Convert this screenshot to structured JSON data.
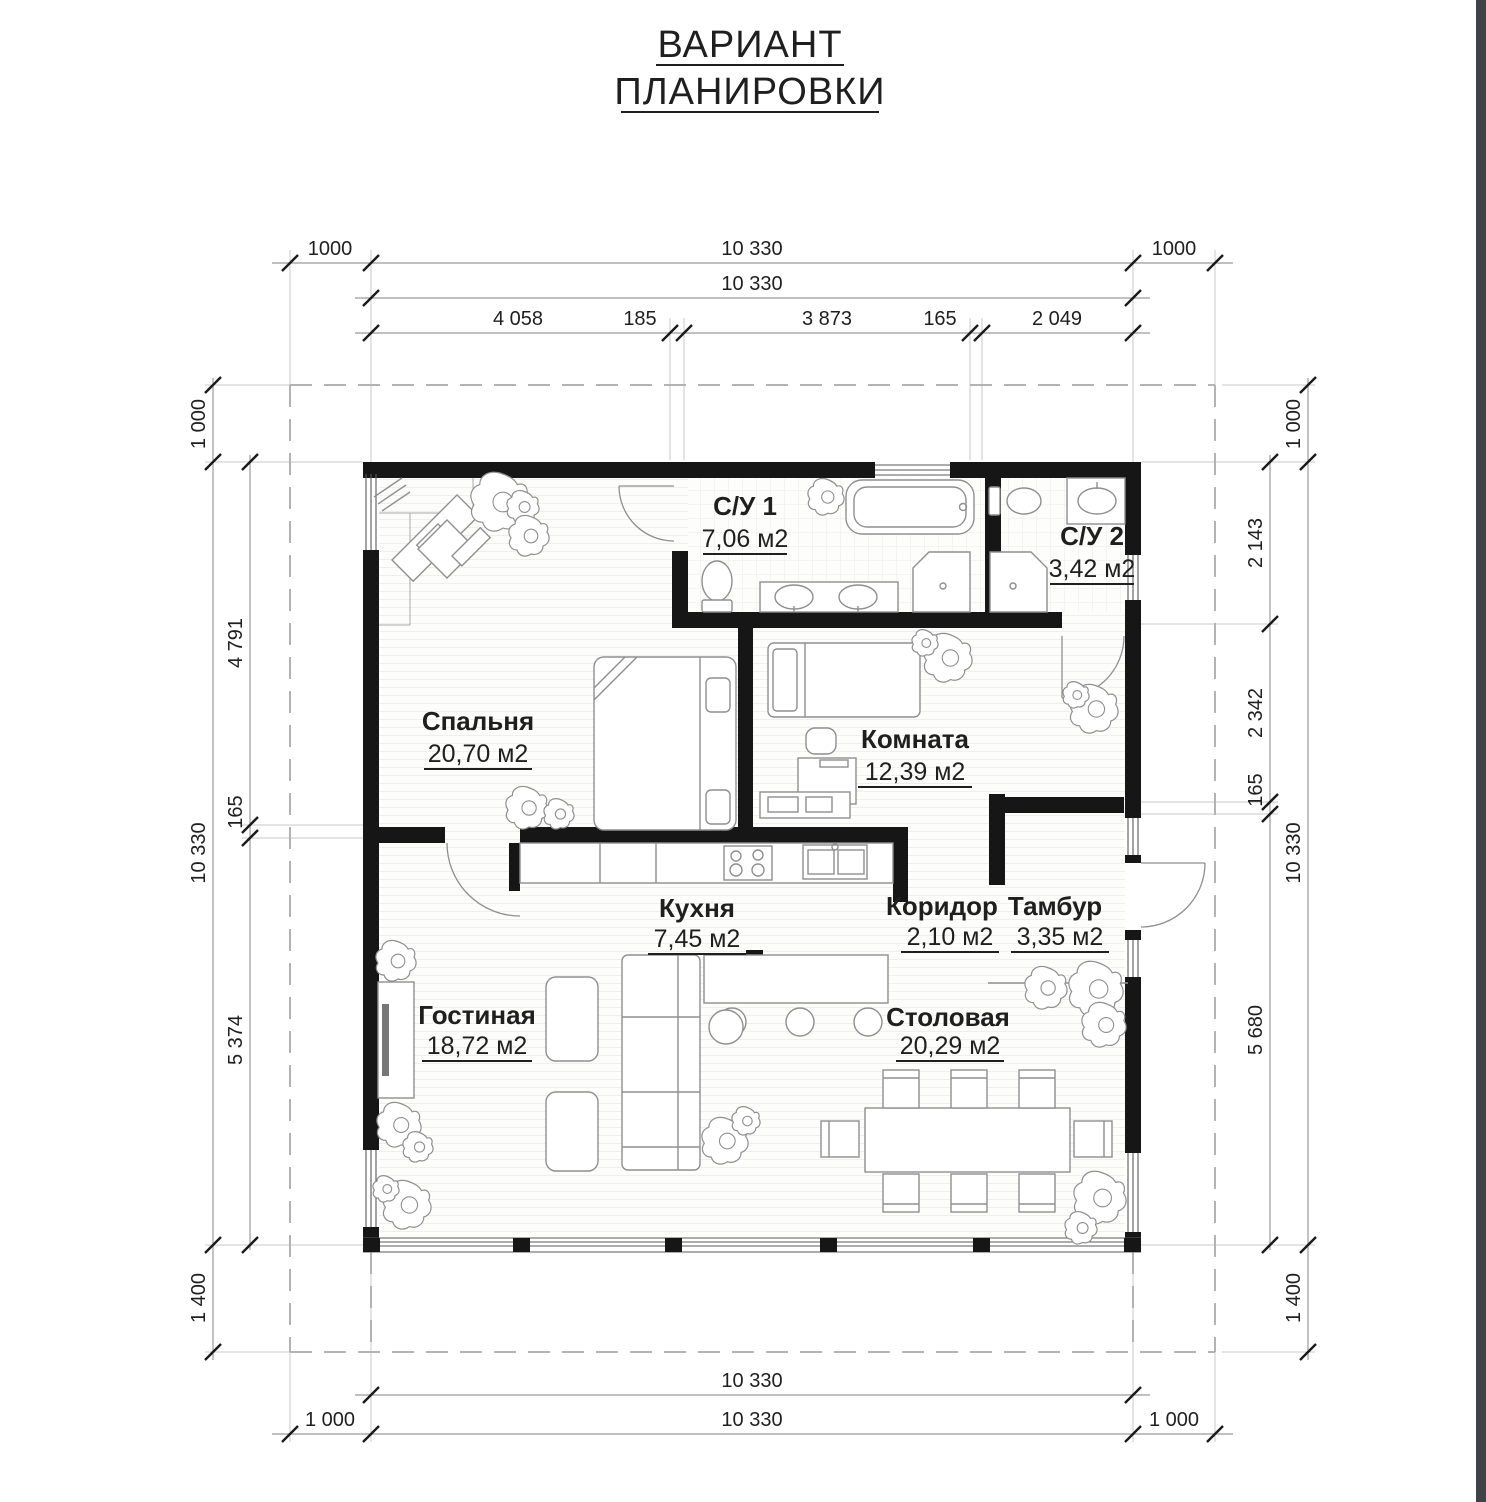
{
  "title": {
    "line1": "ВАРИАНТ",
    "line2": "ПЛАНИРОВКИ"
  },
  "rooms": [
    {
      "id": "spalnya",
      "name": "Спальня",
      "area": "20,70 м2"
    },
    {
      "id": "su1",
      "name": "С/У 1",
      "area": "7,06 м2"
    },
    {
      "id": "su2",
      "name": "С/У 2",
      "area": "3,42 м2"
    },
    {
      "id": "komnata",
      "name": "Комната",
      "area": "12,39 м2"
    },
    {
      "id": "kuhnya",
      "name": "Кухня",
      "area": "7,45 м2"
    },
    {
      "id": "koridor",
      "name": "Коридор",
      "area": "2,10 м2"
    },
    {
      "id": "tambur",
      "name": "Тамбур",
      "area": "3,35 м2"
    },
    {
      "id": "gostinaya",
      "name": "Гостиная",
      "area": "18,72 м2"
    },
    {
      "id": "stolovaya",
      "name": "Столовая",
      "area": "20,29 м2"
    }
  ],
  "dimensions": {
    "top": {
      "row1": [
        "1000",
        "10 330",
        "1000"
      ],
      "row2": [
        "10 330"
      ],
      "row3": [
        "4 058",
        "185",
        "3 873",
        "165",
        "2 049"
      ]
    },
    "bottom": {
      "row1": [
        "10 330"
      ],
      "row2": [
        "1 000",
        "10 330",
        "1 000"
      ]
    },
    "left": {
      "outer": [
        "1 000",
        "10 330",
        "1 400"
      ],
      "inner": [
        "4 791",
        "165",
        "5 374"
      ]
    },
    "right": {
      "outer": [
        "1 000",
        "10 330",
        "1 400"
      ],
      "inner": [
        "2 143",
        "2 342",
        "165",
        "5 680"
      ]
    }
  },
  "colors": {
    "wall": "#161616",
    "dimension_line": "#9b9b9b",
    "text": "#1f1f1f",
    "furniture": "#8f8f8f",
    "edge_strip": "#3f4347"
  }
}
